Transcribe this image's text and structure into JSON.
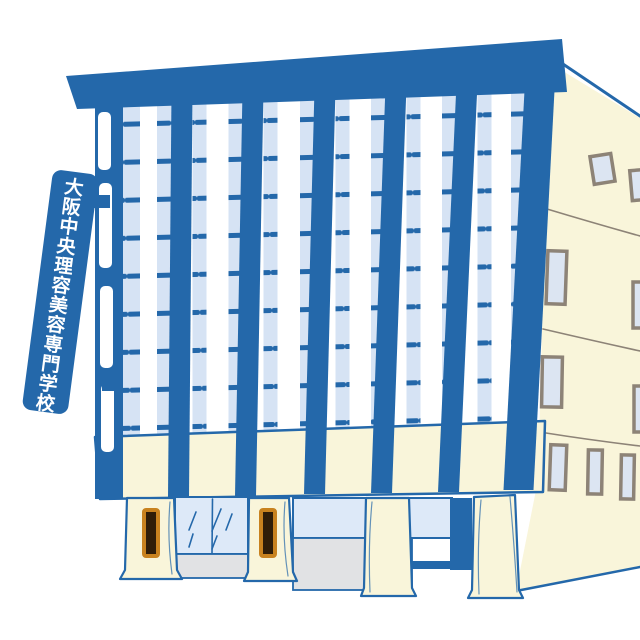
{
  "sign": {
    "text": "大阪中央理容美容専門学校",
    "chars": [
      "大",
      "阪",
      "中",
      "央",
      "理",
      "容",
      "美",
      "容",
      "専",
      "門",
      "学",
      "校"
    ]
  },
  "colors": {
    "blue": "#2468aa",
    "windowBlue": "#d6e3f4",
    "glassBlue": "#dde9f8",
    "cream": "#f9f5da",
    "stepGray": "#e1e2e4",
    "lineGray": "#8d8377",
    "sideWindowBlue": "#dce5f2",
    "signFrameBrown": "#c8821f",
    "signDarkBrown": "#2f1d08",
    "white": "#ffffff"
  }
}
